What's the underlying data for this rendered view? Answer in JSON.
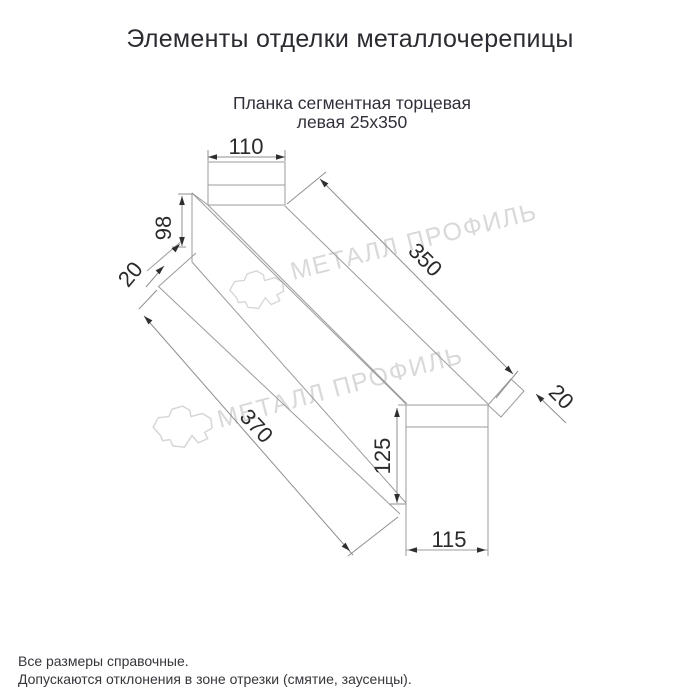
{
  "page": {
    "title": "Элементы отделки металлочерепицы"
  },
  "product": {
    "subtitle_line1": "Планка сегментная торцевая",
    "subtitle_line2": "левая 25х350"
  },
  "drawing": {
    "dim_labels": {
      "top_width": "110",
      "left_height": "98",
      "left_hem": "20",
      "top_length": "350",
      "right_hem": "20",
      "bottom_length": "370",
      "right_height": "125",
      "bottom_width": "115"
    }
  },
  "watermark": {
    "text": "МЕТАЛЛ ПРОФИЛЬ"
  },
  "footer": {
    "line1": "Все размеры справочные.",
    "line2": "Допускаются отклонения в зоне отрезки (смятие, заусенцы)."
  },
  "colors": {
    "profile_line": "#9b9b9b",
    "dimension_text": "#2a2a2a",
    "watermark": "#d9d9d9",
    "title_text": "#2b2b31"
  }
}
